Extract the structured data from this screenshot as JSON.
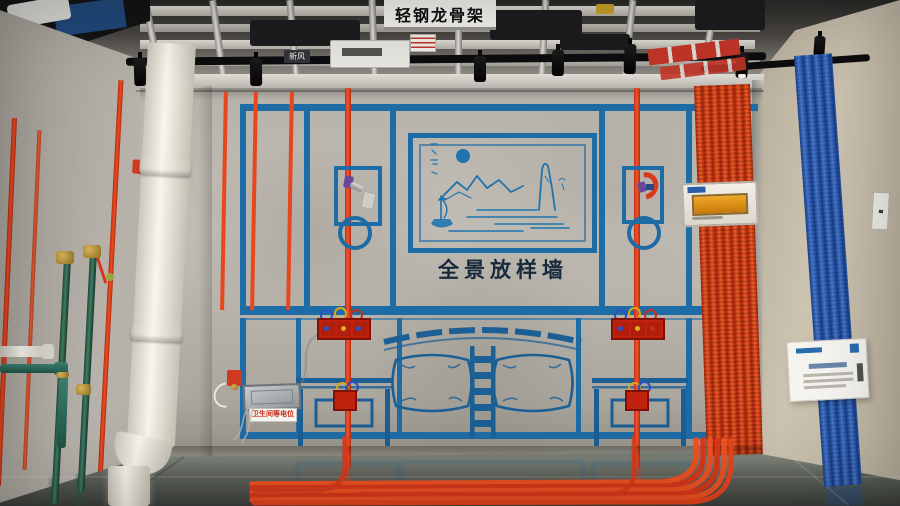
{
  "ceiling": {
    "sign_label": "轻钢龙骨架",
    "vent_label": "新风"
  },
  "main_wall": {
    "title": "全景放样墙"
  },
  "left_wall": {
    "equipotential_label": "卫生间等电位"
  },
  "palette": {
    "tape_blue": "#1e6ca6",
    "conduit_red": "#e0391b",
    "bundle_orange": "#f25c28",
    "bundle_blue": "#1d55a8",
    "pipe_green": "#2e6b55",
    "pvc_white": "#efece4",
    "wall_gray": "#b6b2aa",
    "right_wall_beige": "#cdc3b1",
    "floor_gray_green": "#8a9288"
  }
}
